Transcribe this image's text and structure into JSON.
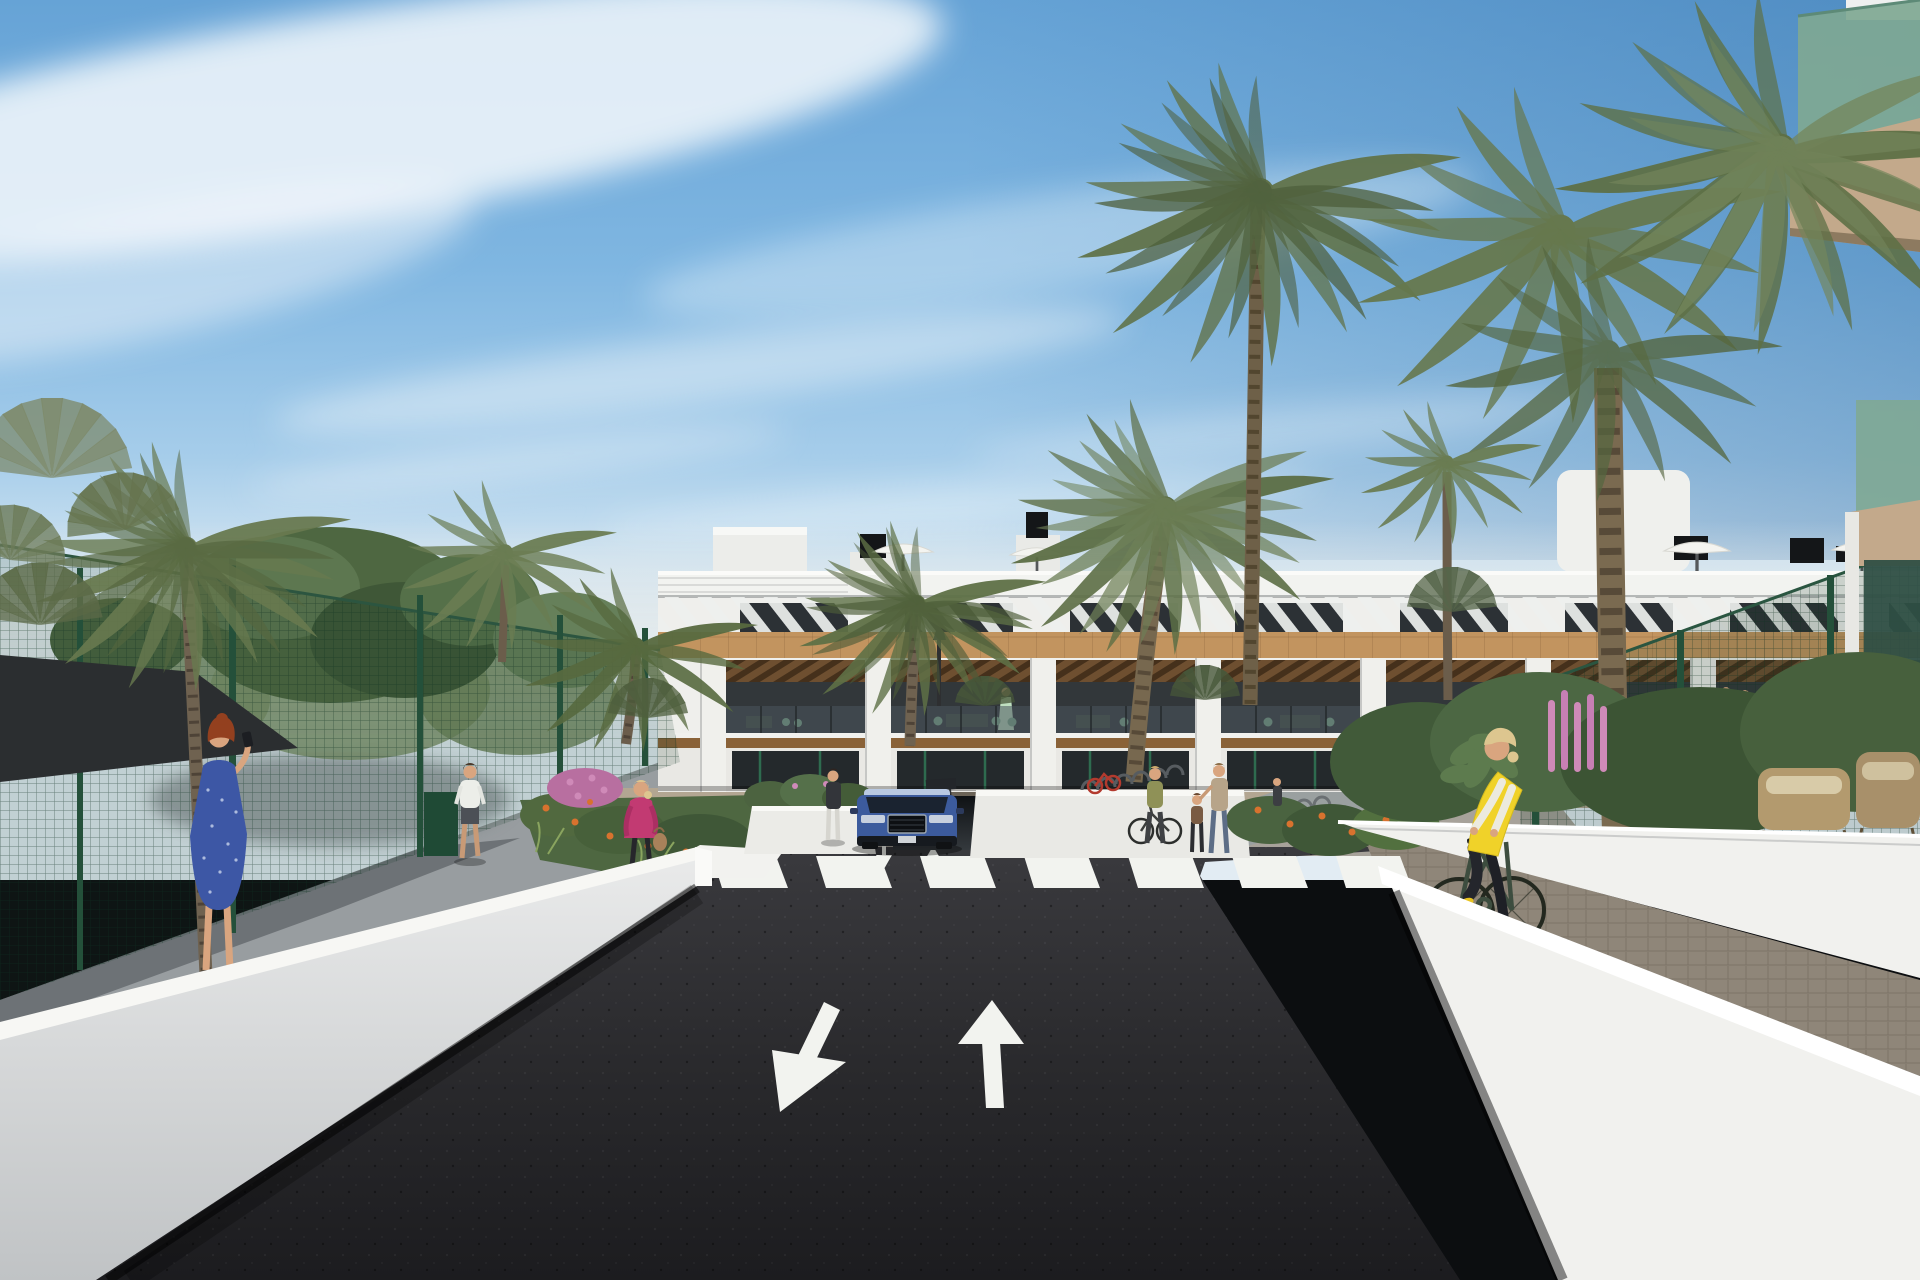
{
  "scene": {
    "type": "architectural-render",
    "objects": [
      "apartment-building",
      "rooftop-umbrellas",
      "rooftop-chimneys",
      "palm-trees",
      "fan-palms",
      "leafy-trees",
      "access-road",
      "pedestrian-crossing",
      "lane-arrow-toward-viewer",
      "lane-arrow-away",
      "garage-ramp",
      "blue-suv",
      "white-perimeter-walls",
      "paved-sidewalk",
      "garden-planters",
      "green-mesh-fence",
      "shade-sail",
      "entry-gate",
      "cyclist-yellow-vest",
      "woman-blue-dress-photographing",
      "woman-pink-jacket",
      "man-white-tshirt",
      "pedestrian-group",
      "balcony-residents",
      "bike-racks",
      "wicker-lounge-furniture",
      "pink-lupine-flowers",
      "orange-flowers"
    ]
  },
  "palette": {
    "sky_top": "#66a3d6",
    "sky_mid": "#8fc0e6",
    "sky_low": "#cfe3f1",
    "cloud": "#f4f8fb",
    "haze": "#dfe6e8",
    "building_white": "#efefec",
    "window_dark": "#2c3135",
    "wood": "#c2945f",
    "wood_dark": "#8a6238",
    "slat_wood": "#6e4f30",
    "interior_dark": "#32373a",
    "glass": "#4a555c",
    "asphalt": "#27272a",
    "road_mark": "#f2f3ef",
    "wall_sun": "#f1f1ee",
    "wall_shade": "#bcbfc1",
    "path_gray": "#989da0",
    "paver": "#8f8679",
    "walkway_tan": "#b3a692",
    "fence_green": "#24503a",
    "sail": "#2b2e30",
    "foliage_dark": "#3f5737",
    "foliage": "#4e6741",
    "foliage_light": "#6d865a",
    "palm": "#64764a",
    "palm_dark": "#4d5e3b",
    "trunk": "#70624e",
    "trunk_dark": "#4f4336",
    "flower_orange": "#d8722e",
    "flower_pink": "#cf8ab8",
    "flower_magenta": "#b86fa0",
    "glass_green": "#7fa893",
    "glass_dark": "#2f4f44",
    "soffit": "#c3a98b",
    "car_blue": "#3c5b9d",
    "vest_yellow": "#f0d229",
    "dress_blue": "#3d57a5",
    "jacket_pink": "#c23a72",
    "skin": "#d9a57f",
    "hair_red": "#93401f",
    "hair_blonde": "#ddc68f",
    "bike_frame": "#39493b",
    "wicker": "#b39a6e"
  }
}
